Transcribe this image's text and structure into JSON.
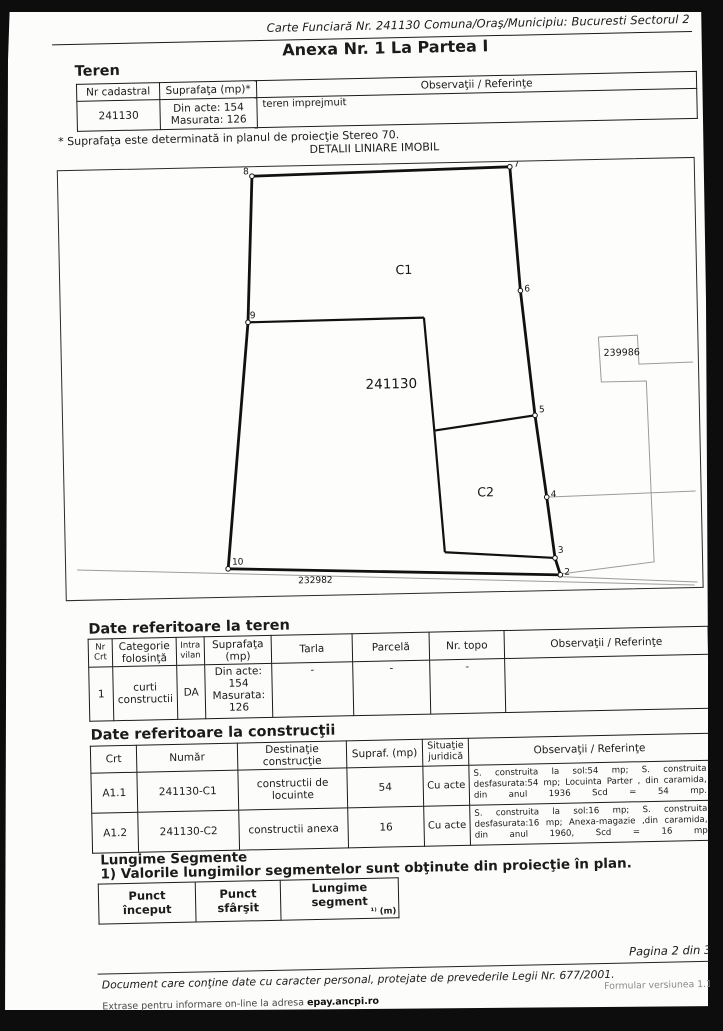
{
  "header": {
    "carte_funciara": "Carte Funciară Nr. 241130 Comuna/Oraş/Municipiu: Bucuresti Sectorul 2",
    "anexa_title": "Anexa Nr. 1 La Partea I"
  },
  "teren": {
    "heading": "Teren",
    "col_nr_cadastral": "Nr cadastral",
    "col_suprafata": "Suprafaţa (mp)*",
    "col_observatii": "Observaţii / Referinţe",
    "nr_cadastral": "241130",
    "suprafata_line1": "Din acte: 154",
    "suprafata_line2": "Masurata: 126",
    "observatii": "teren imprejmuit",
    "footnote": "* Suprafaţa este determinată in planul de proiecţie Stereo 70."
  },
  "diagram": {
    "title": "DETALII LINIARE IMOBIL",
    "parcel_number": "241130",
    "building_c1": "C1",
    "building_c2": "C2",
    "neighbor_parcel": "239986",
    "road_parcel": "232982",
    "points": {
      "p2": "2",
      "p3": "3",
      "p4": "4",
      "p5": "5",
      "p6": "6",
      "p7": "7",
      "p8": "8",
      "p9": "9",
      "p10": "10"
    }
  },
  "teren_detail": {
    "heading": "Date referitoare la teren",
    "headers": {
      "nr_l1": "Nr",
      "nr_l2": "Crt",
      "categorie_l1": "Categorie",
      "categorie_l2": "folosinţă",
      "intra_l1": "Intra",
      "intra_l2": "vilan",
      "suprafata_l1": "Suprafaţa",
      "suprafata_l2": "(mp)",
      "tarla": "Tarla",
      "parcela": "Parcelă",
      "nr_topo": "Nr. topo",
      "observatii": "Observaţii / Referinţe"
    },
    "row": {
      "nr": "1",
      "categorie_l1": "curti",
      "categorie_l2": "constructii",
      "intravilan": "DA",
      "s1": "Din acte:",
      "s2": "154",
      "s3": "Masurata:",
      "s4": "126",
      "tarla": "-",
      "parcela": "-",
      "nr_topo": "-",
      "observatii": ""
    }
  },
  "constructii": {
    "heading": "Date referitoare la construcţii",
    "headers": {
      "crt": "Crt",
      "numar": "Număr",
      "destinatie_l1": "Destinaţie",
      "destinatie_l2": "construcţie",
      "supraf": "Supraf. (mp)",
      "situatie_l1": "Situaţie",
      "situatie_l2": "juridică",
      "observatii": "Observaţii / Referinţe"
    },
    "rows": [
      {
        "crt": "A1.1",
        "numar": "241130-C1",
        "destinatie_l1": "constructii de",
        "destinatie_l2": "locuinte",
        "supraf": "54",
        "situatie": "Cu acte",
        "observatii": "S. construita la sol:54 mp; S. construita desfasurata:54 mp; Locuinta Parter , din caramida, din anul 1936 Scd = 54 mp."
      },
      {
        "crt": "A1.2",
        "numar": "241130-C2",
        "destinatie_l1": "constructii anexa",
        "destinatie_l2": "",
        "supraf": "16",
        "situatie": "Cu acte",
        "observatii": "S. construita la sol:16 mp; S. construita desfasurata:16 mp; Anexa-magazie ,din caramida, din anul 1960, Scd = 16 mp"
      }
    ]
  },
  "segmente": {
    "heading": "Lungime Segmente",
    "note": "1) Valorile lungimilor segmentelor sunt obţinute din proiecţie în plan.",
    "col_start_l1": "Punct",
    "col_start_l2": "început",
    "col_end_l1": "Punct",
    "col_end_l2": "sfârşit",
    "col_len_l1": "Lungime segment",
    "col_len_l2": "¹⁾ (m)"
  },
  "footer": {
    "pagina": "Pagina 2 din 3",
    "legal": "Document care conţine date cu caracter personal, protejate de prevederile Legii Nr. 677/2001.",
    "formular": "Formular versiunea 1.1",
    "extrase_prefix": "Extrase pentru informare on-line la adresa ",
    "extrase_site": "epay.ancpi.ro"
  }
}
